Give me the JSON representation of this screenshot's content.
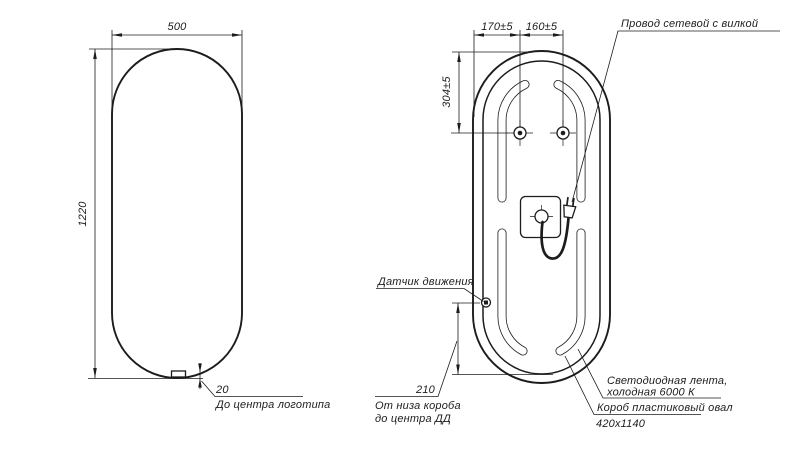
{
  "drawing": {
    "front_view": {
      "width_dim": "500",
      "height_dim": "1220",
      "logo_offset_dim": "20",
      "logo_note": "До центра логотипа"
    },
    "back_view": {
      "mount_offset_dim": "170±5",
      "mount_spacing_dim": "160±5",
      "mount_top_dim": "304±5",
      "power_cord_note": "Провод сетевой с вилкой",
      "motion_sensor_note": "Датчик движения",
      "sensor_height_dim": "210",
      "sensor_height_note_line1": "От низа короба",
      "sensor_height_note_line2": "до центра ДД",
      "led_strip_note_line1": "Светодиодная лента,",
      "led_strip_note_line2": "холодная 6000 К",
      "box_note_line1": "Короб пластиковый овал",
      "box_note_line2": "420х1140"
    },
    "colors": {
      "line": "#1c1c1c",
      "background": "#ffffff"
    }
  }
}
